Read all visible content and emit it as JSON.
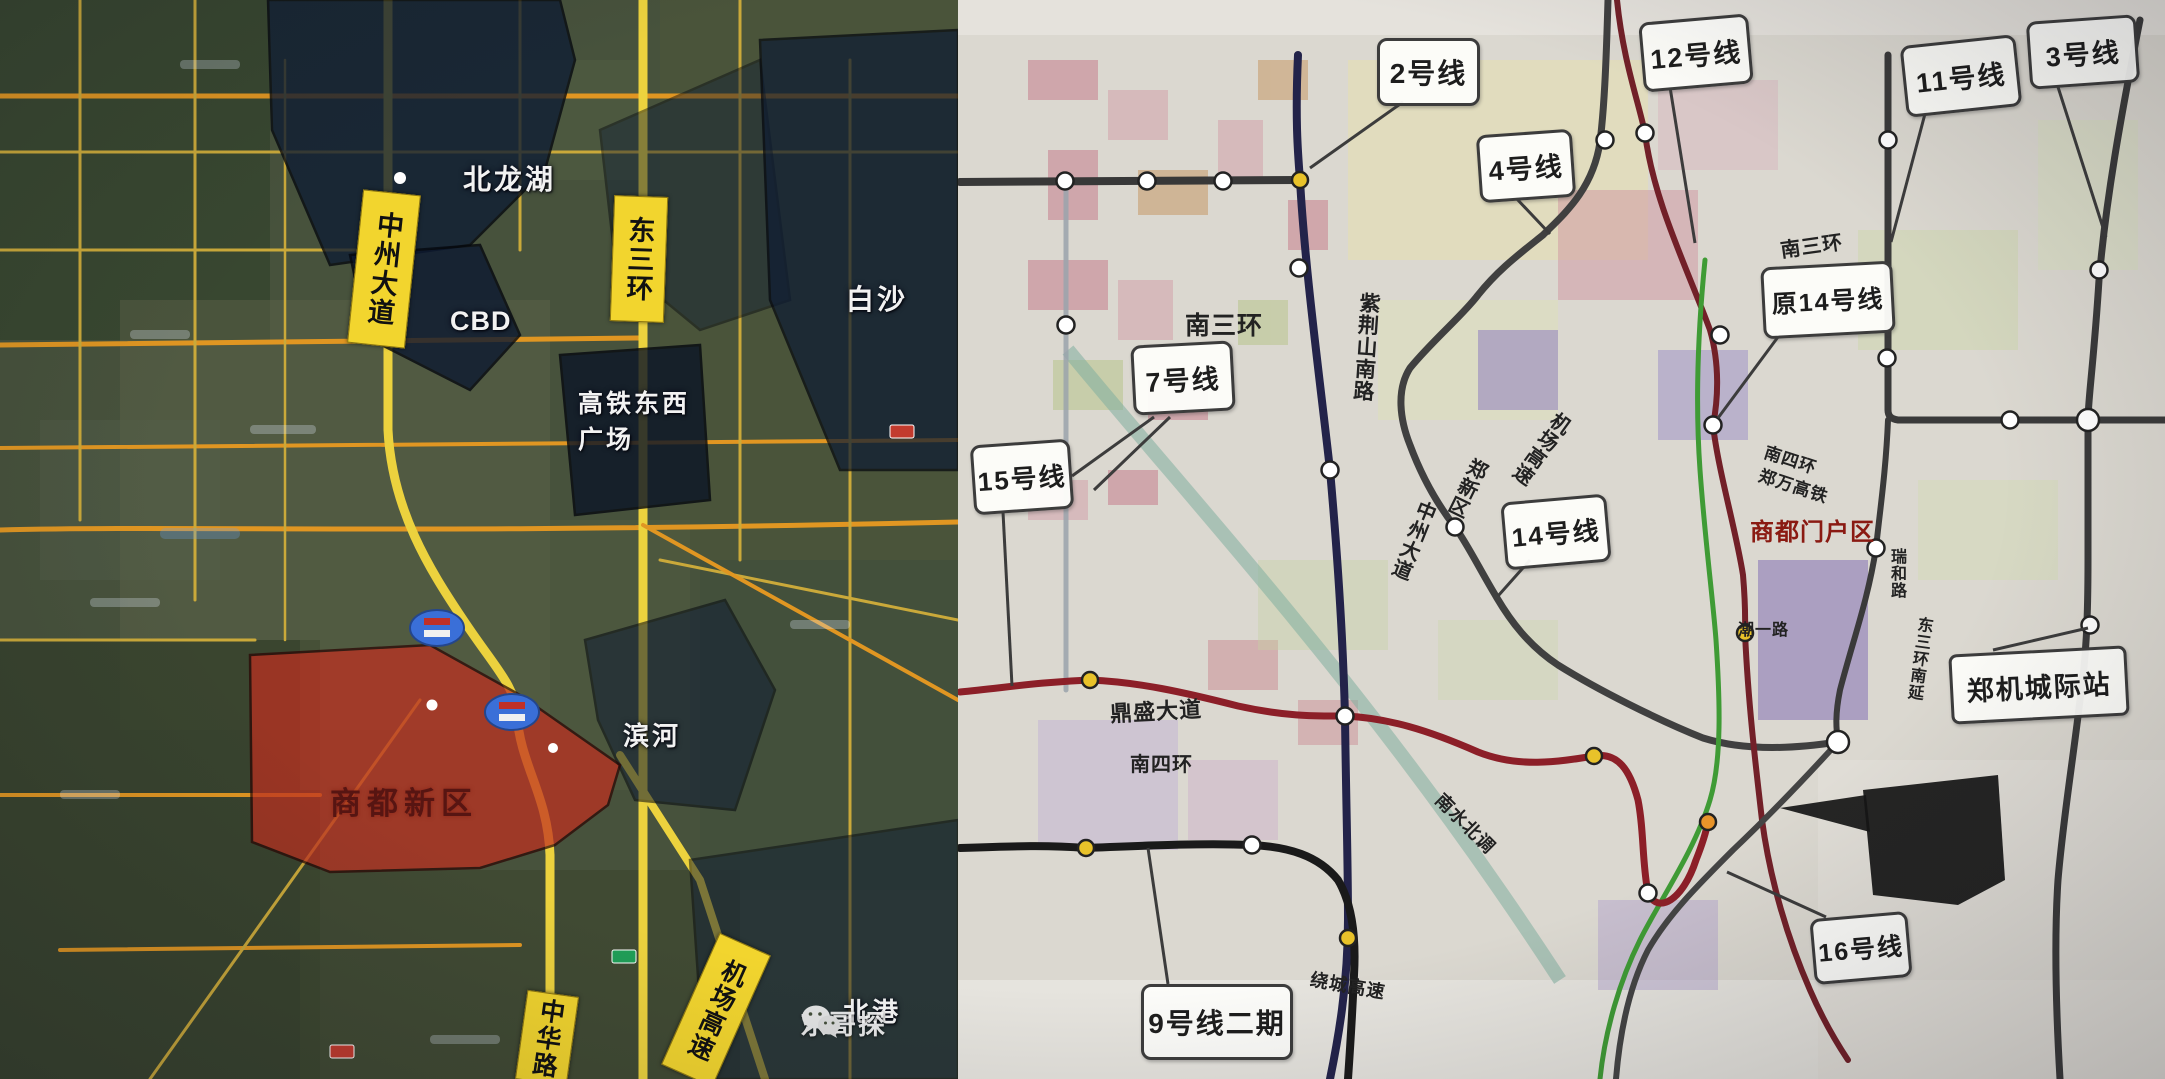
{
  "left_map": {
    "labels": {
      "beilonghu": "北龙湖",
      "cbd": "CBD",
      "baisha": "白沙",
      "gaotie_line1": "高铁东西",
      "gaotie_line2": "广场",
      "shangdu": "商都新区",
      "binhe": "滨河",
      "beigang": "北港"
    },
    "ribbons": {
      "zhongzhou": "中州大道",
      "dongsanhuan": "东三环",
      "zhonghua": "中华路",
      "jichang": "机场高速"
    },
    "watermark": {
      "icon": "wechat-icon",
      "text": "东哥探"
    },
    "colors": {
      "road_yellow": "#ecd23e",
      "road_orange": "#e09622",
      "zone_dark": "#0d1b33",
      "zone_red": "#c03020",
      "ribbon_yellow": "#f2d52e"
    }
  },
  "right_map": {
    "bubbles": [
      {
        "label": "2号线"
      },
      {
        "label": "4号线"
      },
      {
        "label": "12号线"
      },
      {
        "label": "11号线"
      },
      {
        "label": "3号线"
      },
      {
        "label": "7号线"
      },
      {
        "label": "15号线"
      },
      {
        "label": "原14号线"
      },
      {
        "label": "14号线"
      },
      {
        "label": "9号线二期"
      },
      {
        "label": "16号线"
      }
    ],
    "station_box": {
      "label": "郑机城际站"
    },
    "road_labels": [
      {
        "text": "南三环"
      },
      {
        "text": "南三环"
      },
      {
        "text": "紫荆山南路"
      },
      {
        "text": "中州大道"
      },
      {
        "text": "郑新区"
      },
      {
        "text": "机场高速"
      },
      {
        "text": "南四环"
      },
      {
        "text": "郑万高铁"
      },
      {
        "text": "商都门户区"
      },
      {
        "text": "鼎盛大道"
      },
      {
        "text": "南四环"
      },
      {
        "text": "潮一路"
      },
      {
        "text": "瑞和路"
      },
      {
        "text": "东三环南延"
      },
      {
        "text": "南水北调"
      },
      {
        "text": "绕城高速"
      }
    ],
    "colors": {
      "line2_navy": "#23234a",
      "line12_maroon": "#722028",
      "line15_red": "#8c1f28",
      "line_green": "#3f9b35",
      "line_dark": "#3a3a3a",
      "station_yellow": "#e8c22a",
      "station_orange": "#e8942a",
      "gateway_red": "#8a1a12"
    }
  }
}
